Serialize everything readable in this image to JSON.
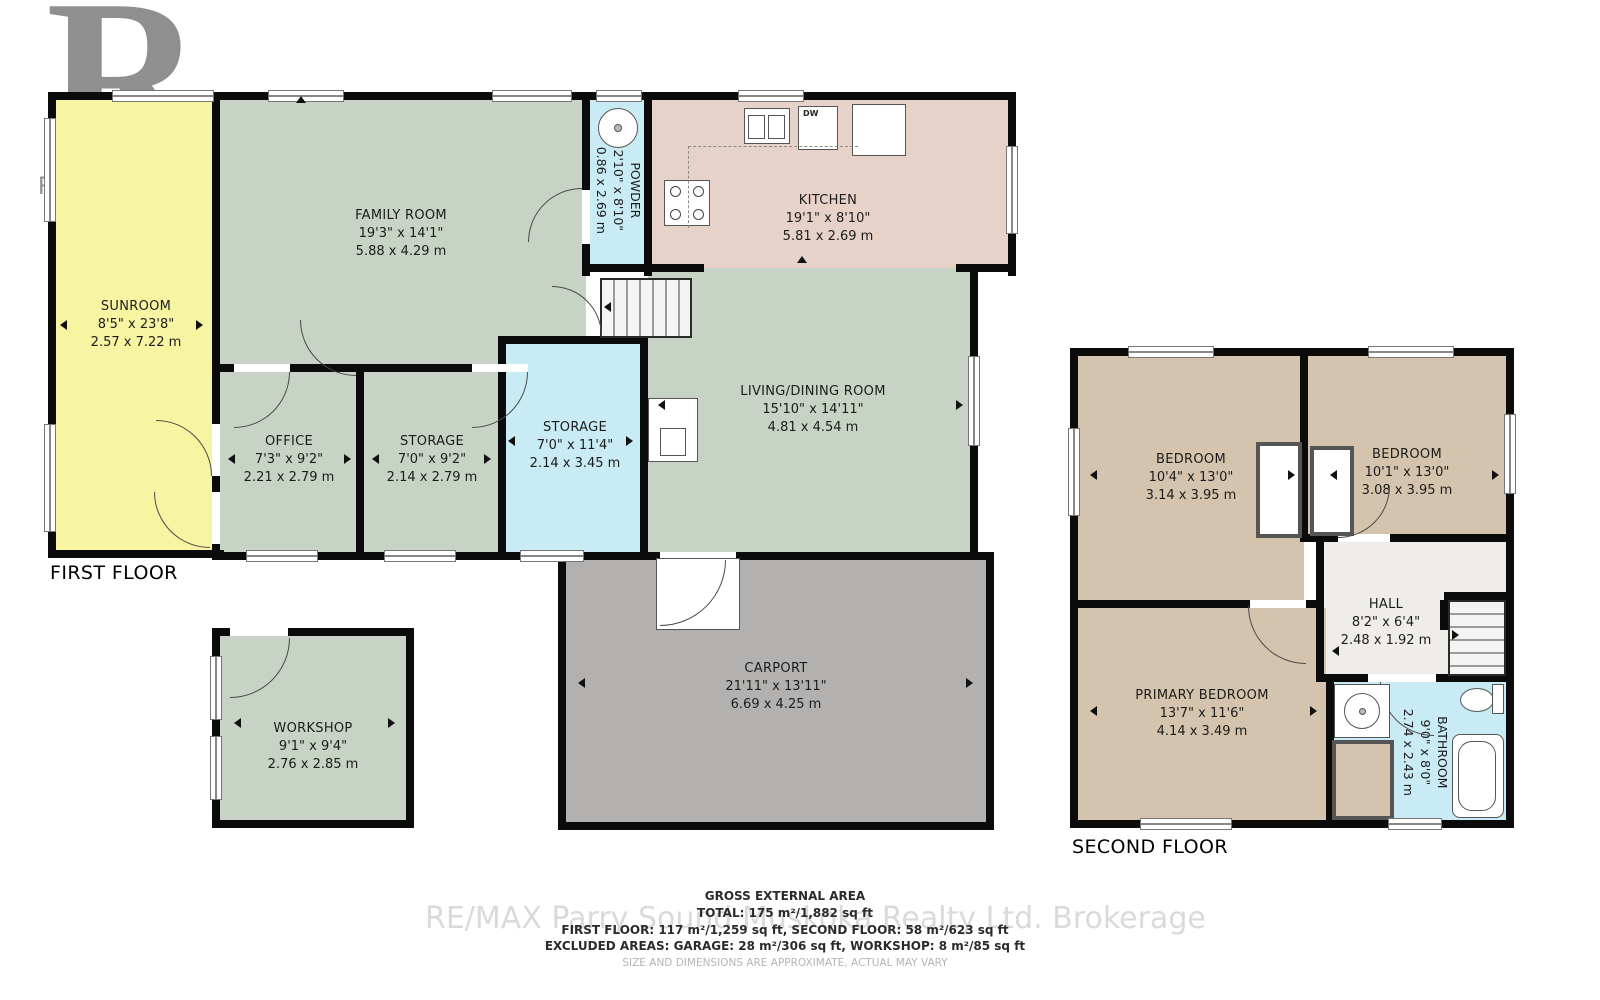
{
  "logo": {
    "r": "R",
    "label": "REALTOR®"
  },
  "first_floor": {
    "title": "FIRST FLOOR",
    "rooms": {
      "sunroom": {
        "name": "SUNROOM",
        "imperial": "8'5\" x 23'8\"",
        "metric": "2.57 x 7.22 m"
      },
      "family_room": {
        "name": "FAMILY ROOM",
        "imperial": "19'3\" x 14'1\"",
        "metric": "5.88 x 4.29 m"
      },
      "powder": {
        "name": "POWDER",
        "imperial": "2'10\" x 8'10\"",
        "metric": "0.86 x 2.69 m"
      },
      "kitchen": {
        "name": "KITCHEN",
        "imperial": "19'1\" x 8'10\"",
        "metric": "5.81 x 2.69 m"
      },
      "living_dining": {
        "name": "LIVING/DINING ROOM",
        "imperial": "15'10\" x 14'11\"",
        "metric": "4.81 x 4.54 m"
      },
      "office": {
        "name": "OFFICE",
        "imperial": "7'3\" x 9'2\"",
        "metric": "2.21 x 2.79 m"
      },
      "storage_small": {
        "name": "STORAGE",
        "imperial": "7'0\" x 9'2\"",
        "metric": "2.14 x 2.79 m"
      },
      "storage_tall": {
        "name": "STORAGE",
        "imperial": "7'0\" x 11'4\"",
        "metric": "2.14 x 3.45 m"
      },
      "carport": {
        "name": "CARPORT",
        "imperial": "21'11\" x 13'11\"",
        "metric": "6.69 x 4.25 m"
      },
      "workshop": {
        "name": "WORKSHOP",
        "imperial": "9'1\" x 9'4\"",
        "metric": "2.76 x 2.85 m"
      }
    },
    "labels": {
      "dishwasher": "DW"
    }
  },
  "second_floor": {
    "title": "SECOND FLOOR",
    "rooms": {
      "bedroom_left": {
        "name": "BEDROOM",
        "imperial": "10'4\" x 13'0\"",
        "metric": "3.14 x 3.95 m"
      },
      "bedroom_right": {
        "name": "BEDROOM",
        "imperial": "10'1\" x 13'0\"",
        "metric": "3.08 x 3.95 m"
      },
      "hall": {
        "name": "HALL",
        "imperial": "8'2\" x 6'4\"",
        "metric": "2.48 x 1.92 m"
      },
      "primary_bedroom": {
        "name": "PRIMARY BEDROOM",
        "imperial": "13'7\" x 11'6\"",
        "metric": "4.14 x 3.49 m"
      },
      "bathroom": {
        "name": "BATHROOM",
        "imperial": "9'0\" x 8'0\"",
        "metric": "2.74 x 2.43 m"
      }
    }
  },
  "summary": {
    "heading": "GROSS EXTERNAL AREA",
    "total": "TOTAL: 175 m²/1,882 sq ft",
    "floors": "FIRST FLOOR: 117 m²/1,259 sq ft, SECOND FLOOR: 58 m²/623 sq ft",
    "excluded": "EXCLUDED AREAS: GARAGE: 28 m²/306 sq ft, WORKSHOP: 8 m²/85 sq ft",
    "disclaimer": "SIZE AND DIMENSIONS ARE APPROXIMATE, ACTUAL MAY VARY"
  },
  "watermark": "RE/MAX Parry Sound Muskoka Realty Ltd. Brokerage",
  "colors": {
    "sunroom": "#f7f5a1",
    "green": "#c7d3c4",
    "blue": "#c9ebf5",
    "kitchen": "#e7d2ca",
    "carport": "#b2b1b0",
    "tan": "#d4c4ad",
    "hall": "#efedea",
    "wall": "#0b0b0b"
  }
}
